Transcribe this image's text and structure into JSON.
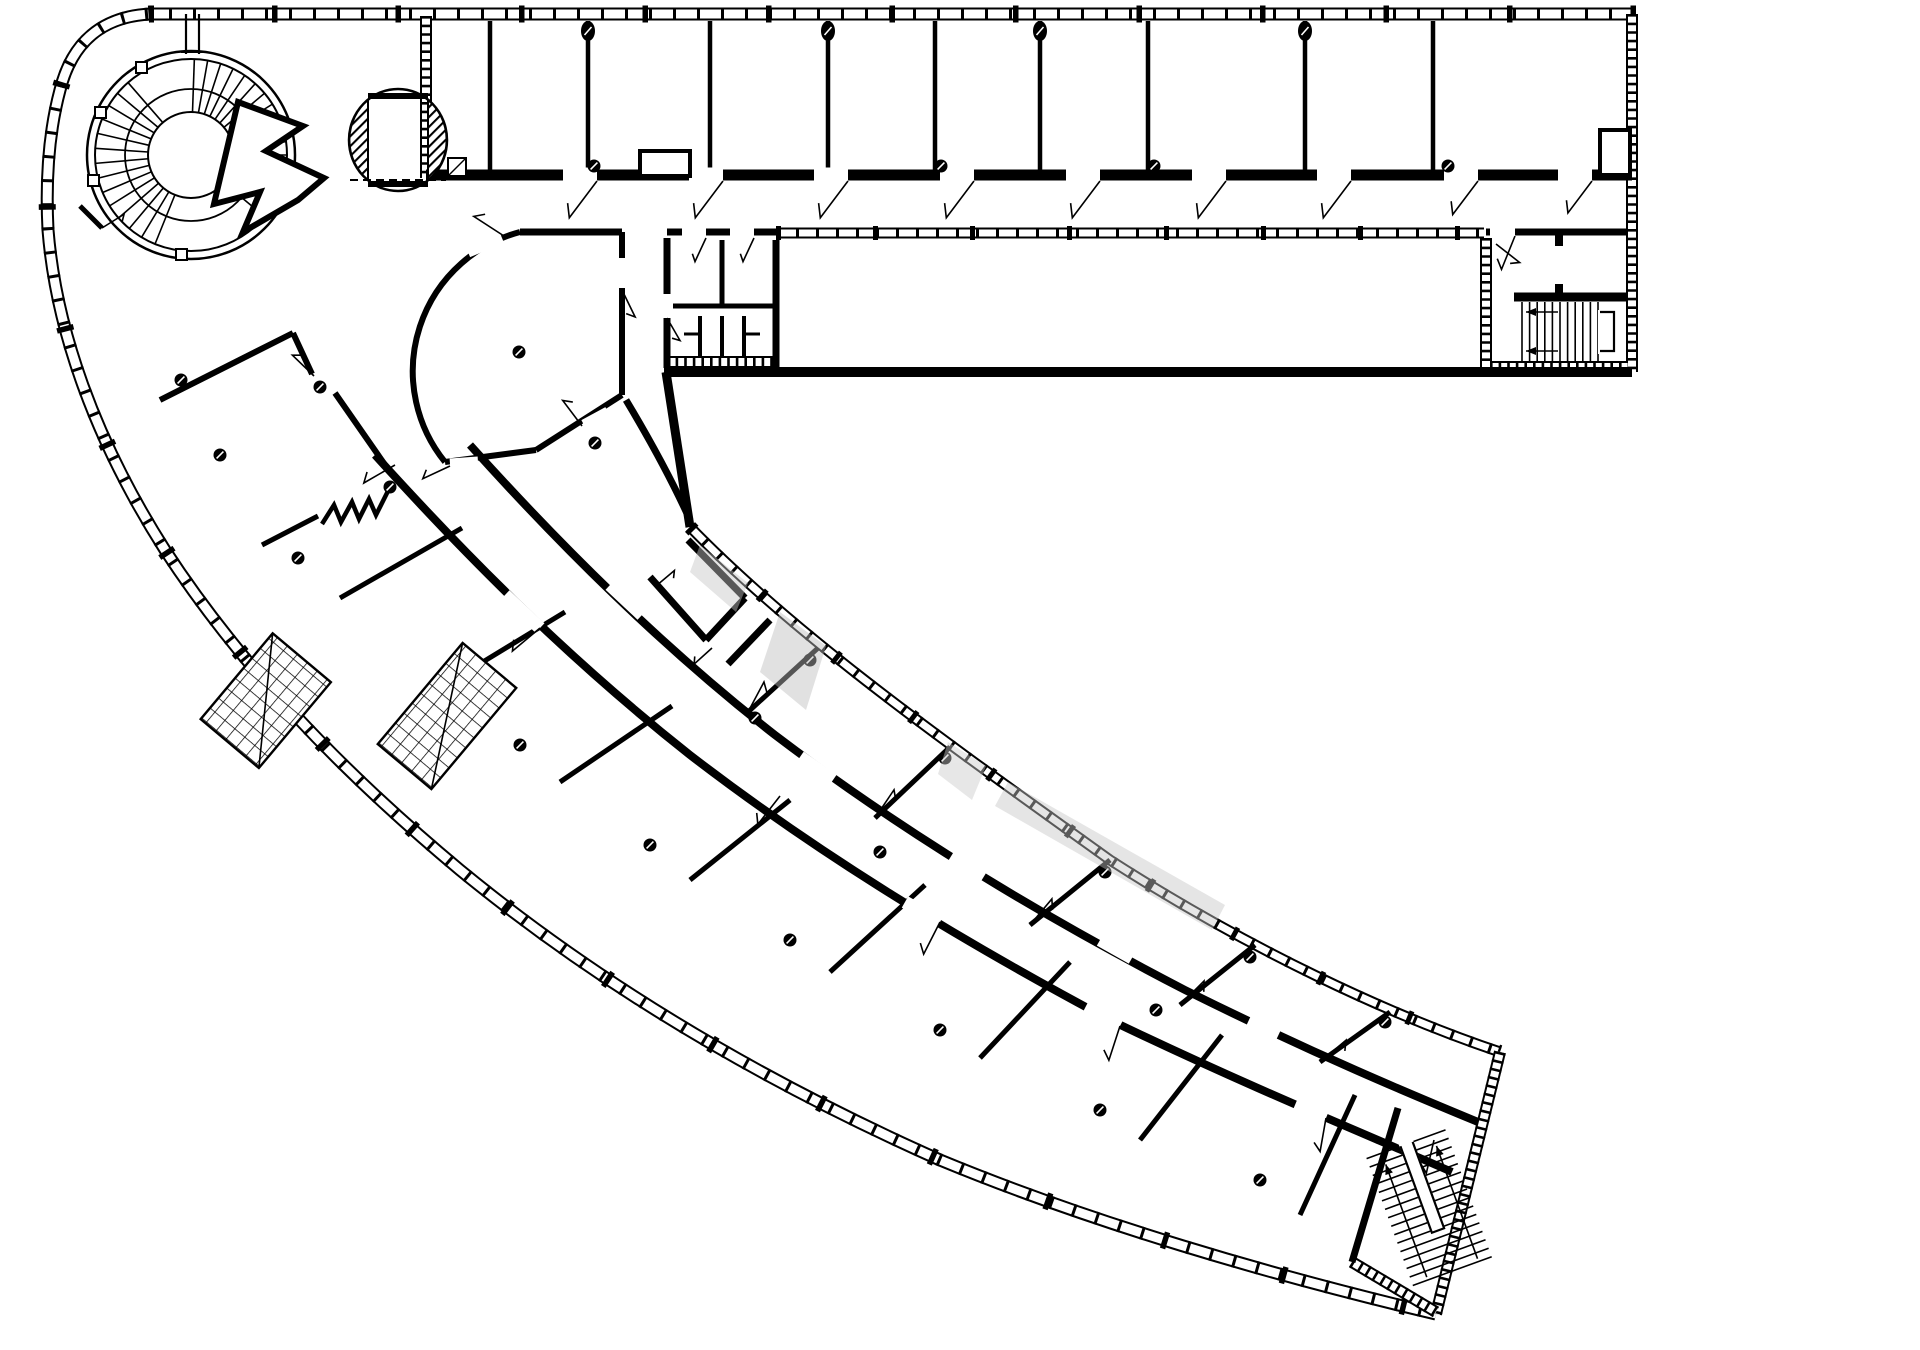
{
  "page": {
    "type": "architectural floor plan drawing",
    "background_color": "#ffffff",
    "ink_color": "#000000",
    "watermark_color": "#bdbdbd",
    "description": "Black and white architectural floor plan of a boomerang-shaped building: a long rectangular top wing of cellular rooms, a curved lower wing of rooms along a central corridor, joined by an atrium hub with a spiral staircase and an oval entrance vestibule"
  },
  "plan": {
    "top_wing": {
      "label": "Top wing cellular rooms",
      "room_count": 10
    },
    "curved_wing": {
      "label": "Curved wing rooms along central corridor",
      "outer_room_count": 9,
      "inner_room_count": 6
    },
    "features": {
      "curtain_wall": {
        "label": "Glazed curtain-wall facade with mullions"
      },
      "inner_curtain_wall": {
        "label": "Glazed interior partition"
      },
      "spiral_staircase": {
        "label": "Spiral staircase"
      },
      "entrance_vestibule": {
        "label": "Oval entrance vestibule"
      },
      "atrium": {
        "label": "Atrium hub"
      },
      "curved_room": {
        "label": "Fan-shaped room"
      },
      "wc_block": {
        "label": "Sanitary core with stalls and fixtures"
      },
      "service_cluster": {
        "label": "Service room cluster"
      },
      "great_hall": {
        "label": "Large open hall"
      },
      "east_stair": {
        "label": "Dog-leg staircase, east core"
      },
      "tip_stair": {
        "label": "Dog-leg staircase at wing end"
      },
      "scissor_stairs": {
        "label": "Gridded stair flights"
      },
      "folding_partition": {
        "label": "Folding partition zigzag symbol"
      },
      "columns": {
        "label": "Structural columns"
      },
      "door_swings": {
        "label": "Door leaf swings"
      },
      "watermark": {
        "label": "Faint gray watermark fragments"
      }
    }
  }
}
